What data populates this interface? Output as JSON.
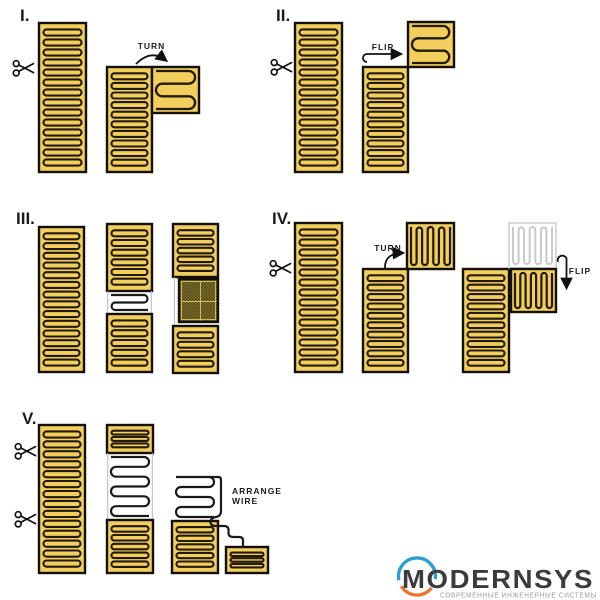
{
  "sections": {
    "s1": {
      "numeral": "I.",
      "turn": "TURN"
    },
    "s2": {
      "numeral": "II.",
      "flip": "FLIP"
    },
    "s3": {
      "numeral": "III."
    },
    "s4": {
      "numeral": "IV.",
      "turn": "TURN",
      "flip": "FLIP"
    },
    "s5": {
      "numeral": "V.",
      "arrange_line1": "ARRANGE",
      "arrange_line2": "WIRE"
    }
  },
  "logo": {
    "brand": "MODERNSYS",
    "tagline": "СОВРЕМЕННЫЕ ИНЖЕНЕРНЫЕ СИСТЕМЫ"
  },
  "icons": {
    "scissors": "scissors-icon"
  },
  "colors": {
    "mat_fill": "#F2CE5D",
    "wire_dark": "#211909",
    "outline": "#131008",
    "exposed_wire": "#1a1a1a",
    "film_edge": "#bdbdbd",
    "ghost": "#c9c9c9",
    "hatch_base": "#453c0f",
    "hatch_check": "#8a7b33",
    "hatch_line": "#d9c75a",
    "arrow": "#111111",
    "logo_blue": "#2e9fd0",
    "logo_orange": "#e9762e",
    "logo_text": "#3b3b3d",
    "logo_tagline": "#9b9b9b"
  }
}
